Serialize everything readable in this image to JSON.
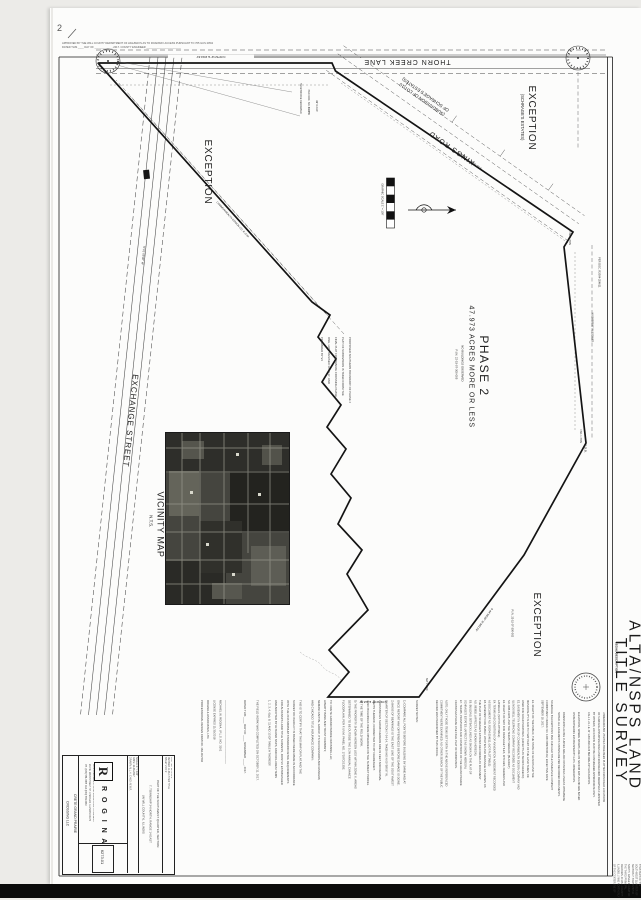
{
  "page": {
    "mark": "2",
    "top_note": "APPROVED BY THE WILL COUNTY DEPARTMENT OF HIGHWAYS AS TO ROADWAY ACCESS PURSUANT TO 765 ILCS 205/2\nDATED THIS ____ DAY OF ____________, 2017.    COUNTY ENGINEER ________________________"
  },
  "title": {
    "line1": "ALTA/NSPS LAND",
    "line2": "TITLE SURVEY",
    "legal_heading": "LEGAL DESCRIPTION",
    "legal_text": "THAT PART OF THE SOUTHWEST QUARTER OF SECTION 7, TOWNSHIP 34 NORTH, RANGE 14 EAST OF THE THIRD PRINCIPAL MERIDIAN, IN WILL COUNTY, ILLINOIS, LYING NORTHERLY OF THE CENTERLINE OF THORN CREEK LANE AND EASTERLY OF EXCHANGE STREET, CONTAINING 47.973 ACRES, MORE OR LESS."
  },
  "roads": {
    "thorn": "THORN CREEK LANE",
    "kings": "KINGS ROAD",
    "exchange": "EXCHANGE STREET",
    "subdivision": "(SUBDIVISION OF LOT 10\nOF SCHRAGE'S ESTATES)"
  },
  "parcel": {
    "phase": "PHASE 2",
    "acres": "47.973 ACRES MORE OR LESS",
    "no_buildings": "NO BUILDINGS OBSERVED",
    "pin": "P.I.N. 22-15-07-300-005",
    "pob": "P.O.B."
  },
  "exceptions": {
    "label1": "EXCEPTION",
    "label2": "EXCEPTION",
    "label3": "EXCEPTION",
    "schrage": "(SCHRAGE'S ESTATES)",
    "pin": "P.I.N. 22-15-07-300-002"
  },
  "vicinity": {
    "title": "VICINITY MAP",
    "nts": "N.T.S."
  },
  "scale": {
    "note": "GRAPHIC SCALE  1\" = 100'"
  },
  "bearings": {
    "top": "N 89°52'12\" E  2016.63'",
    "kings": "S 53°02'04\" E  1385.07'",
    "right": "N 00°58'06\" W  1319.85'",
    "right_doc": "PER DOC. R2004-254611",
    "se": "S 44°58'39\" W  893.04'",
    "bottom": "N 89°54'08\" E  918.86'",
    "exchange": "N 01°05'40\" W"
  },
  "annotations": {
    "phase_note": "PROPOSED SOUTHERN BOUNDARY OF PHASE 2\nPLAT OF SUBDIVISION IS TAKEN FROM THE\nFINAL PLAT FOR PRAIRIE CROSSING PHASE\nONE, LAST REVISED 10-13-17, AND\nPREPARED BY V3",
    "dedicated": "HERETOFORE DEDICATED",
    "doc": "PER DOC. NO. 893855",
    "row": "66' R.O.W.",
    "comed": "COMMONWEALTH EDISON CO. R.O.W.",
    "fnd1": "FND. I. PIPE",
    "fnd2": "FND. I. PIPE",
    "set1": "SET I. ROD"
  },
  "notes": {
    "certification": "SURVEY NOTES:\n \n1) COMPARE ALL POINTS BEFORE BUILDING BY SAME AND AT\n    ONCE REPORT ANY DIFFERENCES BEFORE DAMAGE IS DONE.\n2) BASIS OF BEARINGS IS THE EAST LINE OF THE SOUTHWEST\n    QUARTER OF SECTION 7-34-14, TAKEN AS N 00°58'06\" W.\n3) DISTANCES SHOWN HEREON ARE IN FEET AND DECIMAL\n    PARTS THEREOF, CORRECTED TO 68° FAHRENHEIT.\n4) NO BUILDINGS WERE OBSERVED ON THE SUBJECT PARCEL\n    AT THE TIME OF THE FIELD WORK.\n5) THE PROPERTY SHOWN HEREON LIES WITHIN ZONE X, AREAS\n    DETERMINED TO BE OUTSIDE THE 0.2% ANNUAL CHANCE\n    FLOODPLAIN, PER F.I.R.M. PANEL NO. 17197C0135E.\n \nTO:  CRETE GRAND PRAIRIE CROSSING LLC;\n      LIBERTY BANK AND TRUST COMPANY;\n      NEMANI CAPITAL GROUP, ITS SUCCESSORS AND ASSIGNS;\n      AND CHICAGO TITLE INSURANCE COMPANY:\n \nTHIS IS TO CERTIFY THAT THIS MAP OR PLAT AND THE\nSURVEY ON WHICH IT IS BASED WERE MADE IN ACCORDANCE\nWITH THE 2016 MINIMUM STANDARD DETAIL REQUIREMENTS\nFOR ALTA/NSPS LAND TITLE SURVEYS, JOINTLY ESTABLISHED\nAND ADOPTED BY ALTA AND NSPS, AND INCLUDES ITEMS\n1, 2, 3, 4, 6(a), 8, 11 AND 13 OF TABLE A THEREOF.\n \nTHE FIELD WORK WAS COMPLETED ON OCTOBER 11, 2017.\n \nDATED THIS ____ DAY OF ____ NOVEMBER ____, 2017.\n \n \n_________________________________________\nMICHAEL W. ROGINA, I.P.L.S. NO. 3161\nLICENSE EXPIRES 11/30/2018\nROGINA & ASSOCIATES, LTD.\nPROFESSIONAL DESIGN FIRM NO. 184-002792",
    "schedule": "SCHEDULE B EXCEPTIONS PER CHICAGO TITLE INSURANCE COMPANY\nCOMMITMENT ORDER NO. 1409 008976046 D2, EFFECTIVE DATE\nSEPTEMBER 18, 2017:\n \nE1. RIGHTS OF THE PUBLIC, THE STATE OF ILLINOIS AND THE\n     MUNICIPALITY IN AND TO THAT PART OF THE LAND TAKEN OR\n     USED FOR ROAD PURPOSES. (AFFECTS AS SHOWN HEREON)\nE2. EASEMENT IN FAVOR OF COMMONWEALTH EDISON COMPANY AND\n     ILLINOIS BELL TELEPHONE COMPANY RECORDED AS DOCUMENT\n     NO. R88-13205, AND THE TERMS THEREOF. (BLANKET)\nE3. RIGHTS OF WAY FOR DRAINAGE TILES, DITCHES, FEEDERS AND\n     LATERALS. (NOT PLOTTABLE)\nE4. TERMS AND CONDITIONS OF ANNEXATION AGREEMENT RECORDED\n     AS DOCUMENT NO. R2004-254611. (NOT PLOTTABLE)\nE5. EASEMENT FOR PUBLIC UTILITIES AND DRAINAGE AS SHOWN ON\n     THE PLAT OF SCHRAGE'S ESTATES RECORDED AS DOCUMENT\n     NO. 893855. (AFFECTS AS SHOWN HEREON)\nE6. BUILDING SETBACK LINES AS SHOWN ON THE PLAT OF\n     SCHRAGE'S ESTATES. (AFFECTS AS SHOWN HEREON)\nE7. TERMS, PROVISIONS AND CONDITIONS OF THE GRAND PRAIRIE\n     CROSSINGS PHASE ONE FINAL PLAT OF SUBDIVISION.\n \nNOTE: ONLY THOSE ITEMS SET FORTH IN THE ABOVE REFERENCED\nCOMMITMENT WERE EXAMINED; NO OTHER SEARCH OF THE PUBLIC\nRECORD WAS PERFORMED BY THIS OFFICE.",
    "general": "UNDERGROUND UTILITIES HAVE BEEN PLOTTED FROM FIELD LOCATIONS\nOF SURFACE APPURTENANCES AND FROM RECORD DRAWINGS FURNISHED\nBY OTHERS; LOCATIONS MUST BE CONSIDERED APPROXIMATE ONLY.\nCALL J.U.L.I.E. AT 1-800-892-0123 BEFORE ANY EXCAVATION.\n \nELEVATIONS, WHERE SHOWN, ARE ON NAVD 88 DATUM AND ARE BASED\nON BENCHMARKS ESTABLISHED BY G.P.S. OBSERVATION.\n \nDIMENSIONS ALONG CURVES ARE ARC DISTANCES UNLESS OTHERWISE\nNOTED. ALL EASEMENTS SHOWN ARE PER RECORDED DOCUMENTS."
  },
  "title_block": {
    "client": "CRETE GRAND PRAIRIE\nCROSSING LLC",
    "r": "R",
    "firm": "R O G I N A",
    "address": "CIVIL ENGINEERS • LAND SURVEYORS • PLANNERS\n216 W. MAIN STREET, ST. CHARLES, ILLINOIS 60174\nPH. (630) 584-3455    FAX (630) 584-3460",
    "fields": "SCALE: 1\" = 100'\nDATE: 11-06-2017\nDRAWN: M.L.H.  CHKD: M.W.R.",
    "desc": "PART OF THE SOUTHWEST QUARTER, SECTION\n7, TOWNSHIP 34 NORTH, RANGE 14 EAST\n(IN WILL COUNTY), ILLINOIS",
    "fields2": "PLAT NO. 6273.01-2\nREVISED 11-06-17 PER TITLE\nSHEET 2 OF 2",
    "job": "6273.01"
  }
}
